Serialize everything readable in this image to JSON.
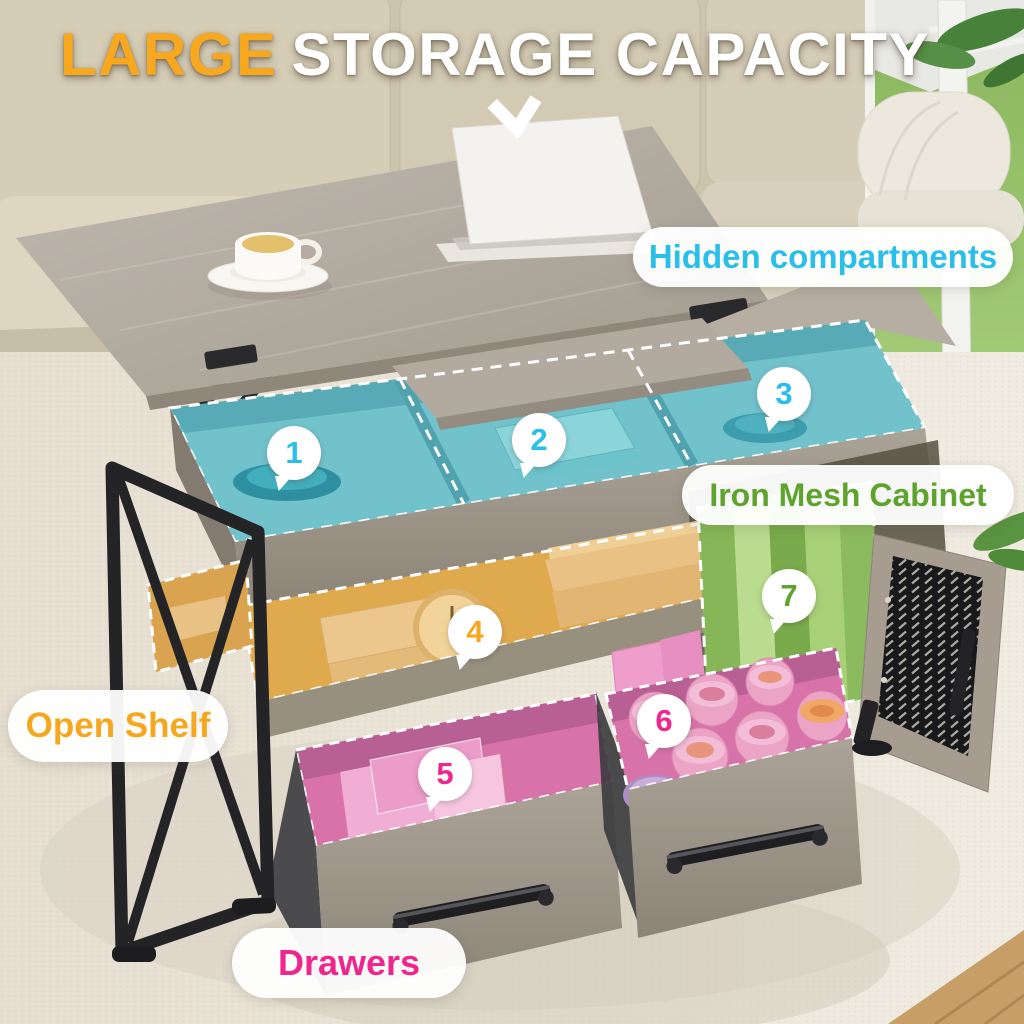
{
  "title": {
    "highlight": "LARGE",
    "rest": "STORAGE CAPACITY"
  },
  "callouts": {
    "hidden_compartments": {
      "label": "Hidden compartments",
      "color": "#29BFE9"
    },
    "iron_mesh_cabinet": {
      "label": "Iron Mesh Cabinet",
      "color": "#5DA32D"
    },
    "open_shelf": {
      "label": "Open Shelf",
      "color": "#F5A81F"
    },
    "drawers": {
      "label": "Drawers",
      "color": "#F0268F"
    }
  },
  "badges": [
    {
      "number": "1",
      "feature": "hidden-compartment",
      "color": "#29BFE9"
    },
    {
      "number": "2",
      "feature": "hidden-compartment",
      "color": "#29BFE9"
    },
    {
      "number": "3",
      "feature": "hidden-compartment",
      "color": "#29BFE9"
    },
    {
      "number": "4",
      "feature": "open-shelf",
      "color": "#F5A81F"
    },
    {
      "number": "5",
      "feature": "drawer",
      "color": "#F0268F"
    },
    {
      "number": "6",
      "feature": "drawer",
      "color": "#F0268F"
    },
    {
      "number": "7",
      "feature": "iron-mesh-cabinet",
      "color": "#5DA32D"
    }
  ],
  "icons": {
    "pointer": "chevron-down-icon"
  },
  "colors": {
    "title_highlight": "#F7A81E",
    "title_text": "#FFFFFF"
  }
}
